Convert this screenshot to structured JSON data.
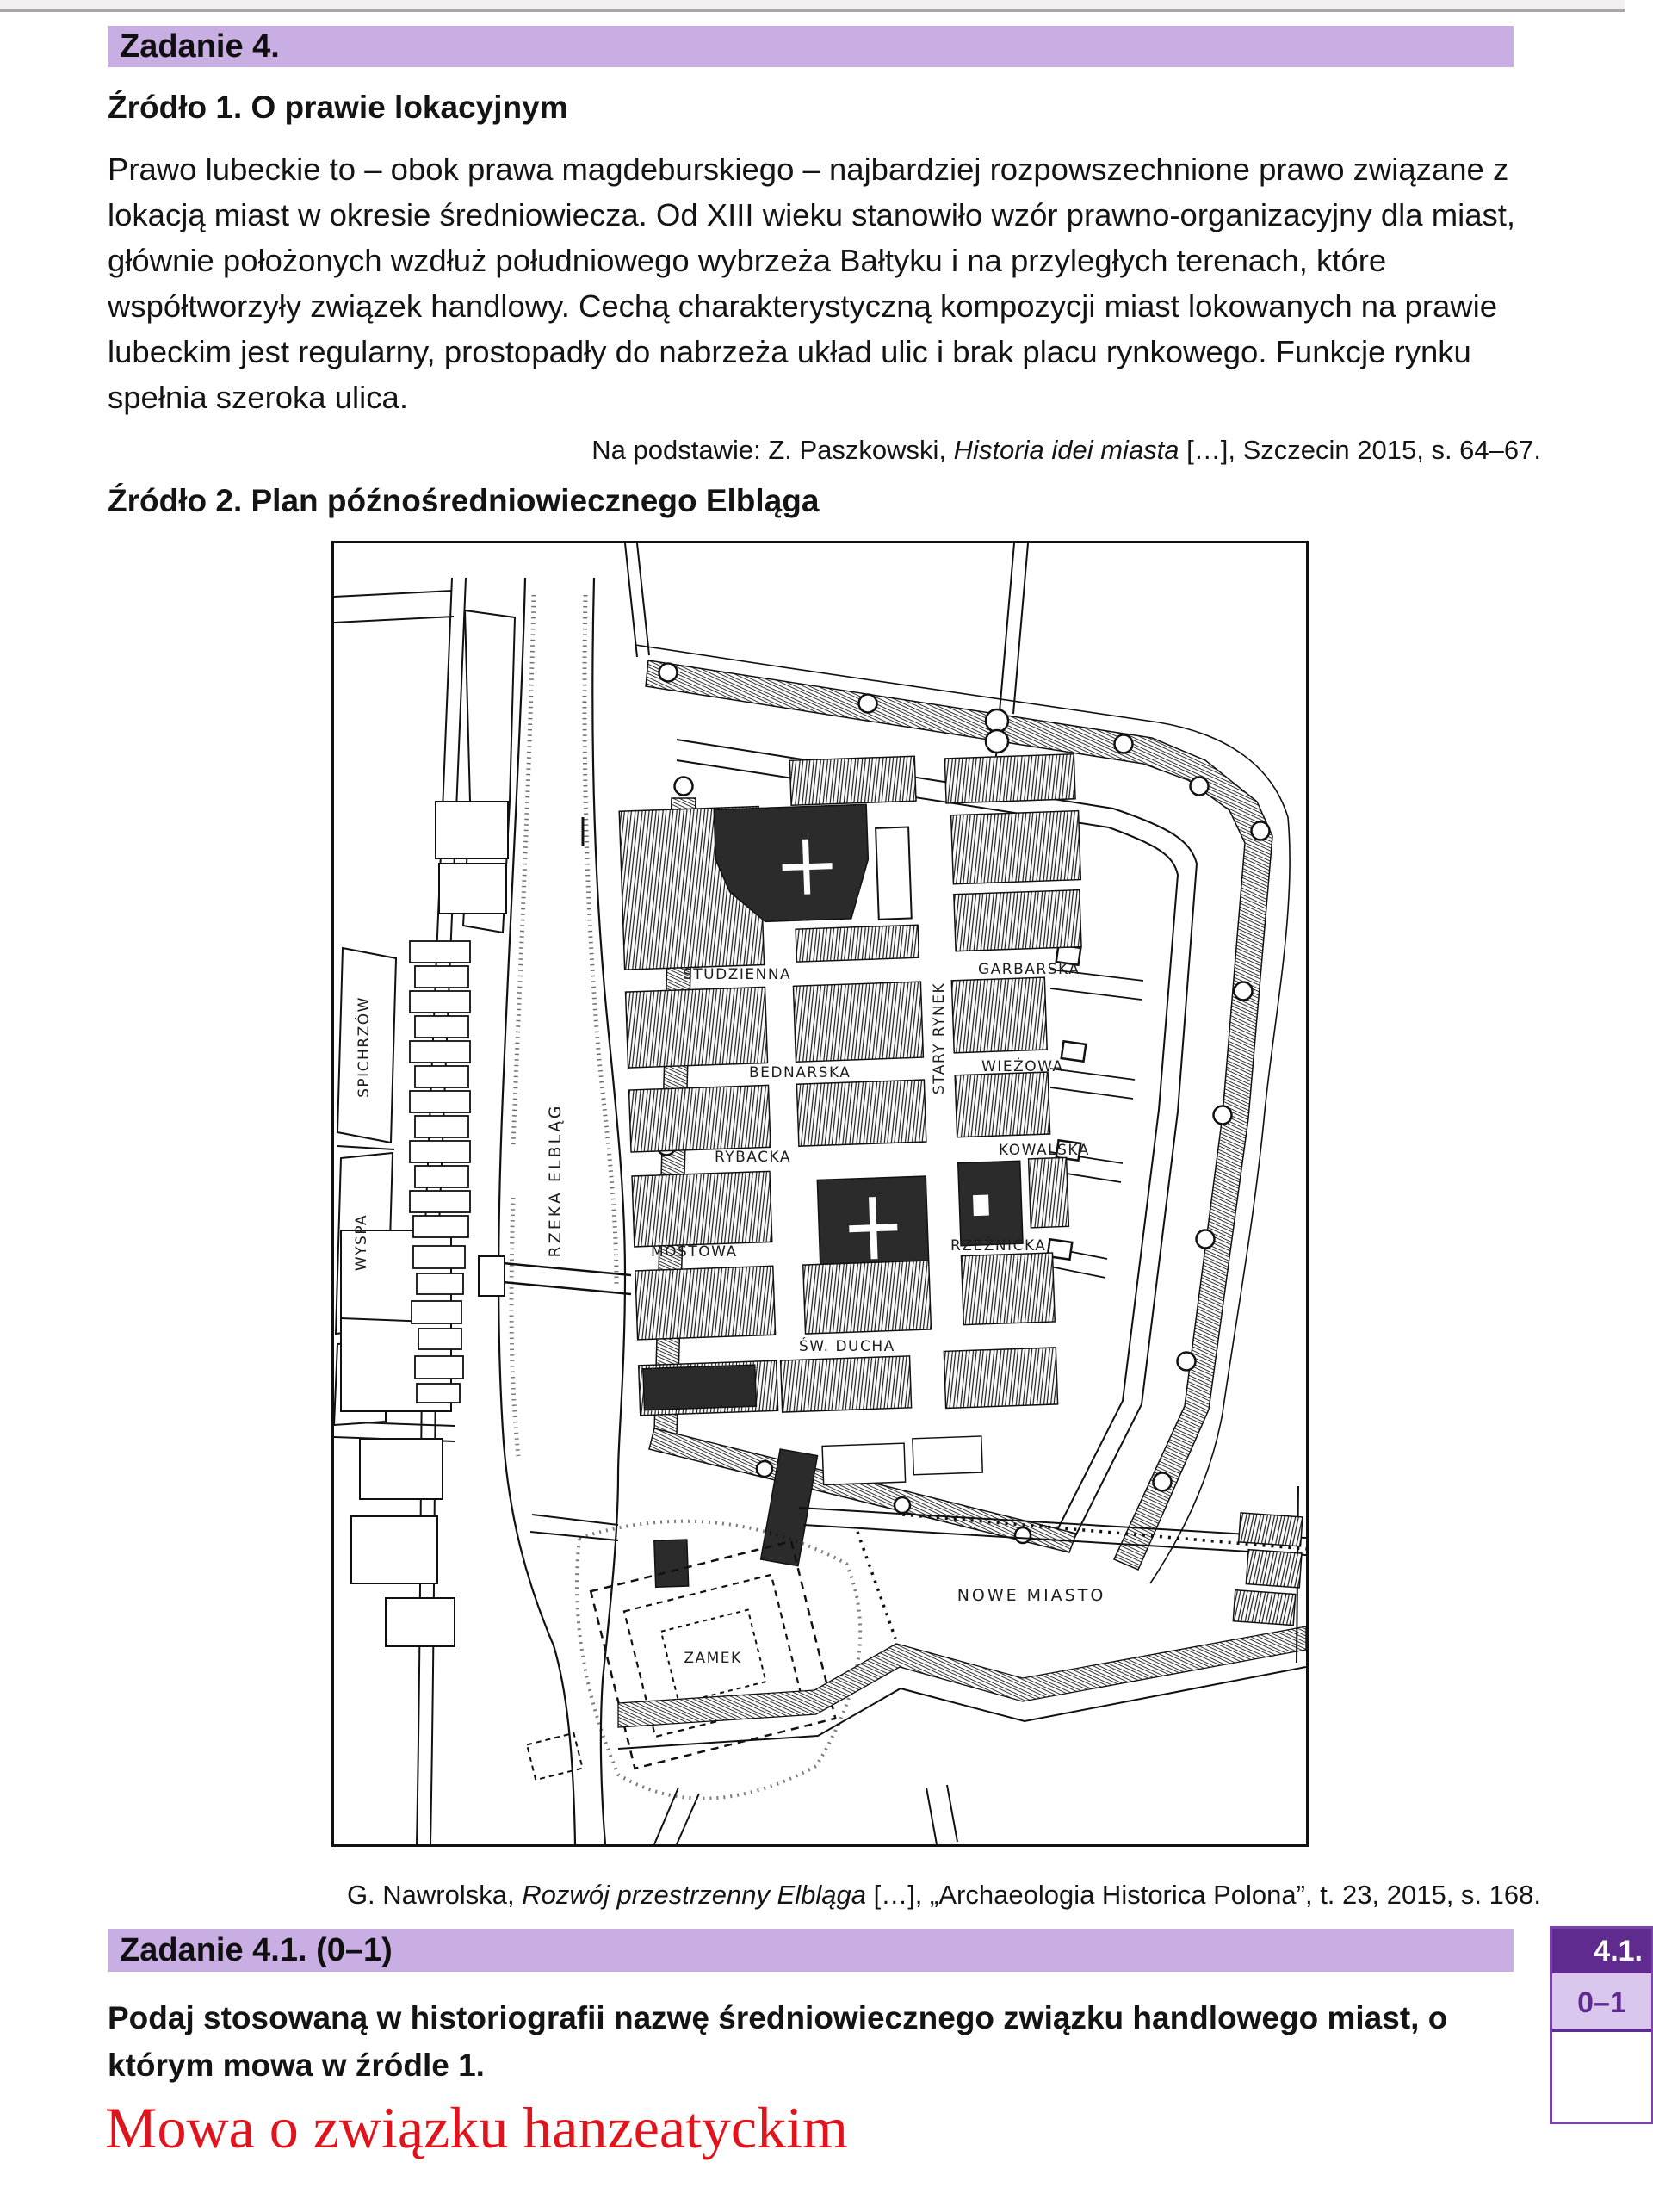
{
  "task4": {
    "title": "Zadanie 4."
  },
  "source1": {
    "heading": "Źródło 1. O prawie lokacyjnym",
    "body": "Prawo lubeckie to – obok prawa magdeburskiego – najbardziej rozpowszechnione prawo związane z lokacją miast w okresie średniowiecza. Od XIII wieku stanowiło wzór prawno-organizacyjny dla miast, głównie położonych wzdłuż południowego wybrzeża Bałtyku i na przyległych terenach, które współtworzyły związek handlowy. Cechą charakterystyczną kompozycji miast lokowanych na prawie lubeckim jest regularny, prostopadły do nabrzeża układ ulic i brak placu rynkowego. Funkcje rynku spełnia szeroka ulica.",
    "citation_prefix": "Na podstawie: Z. Paszkowski, ",
    "citation_title": "Historia idei miasta",
    "citation_suffix": " […], Szczecin 2015, s. 64–67."
  },
  "source2": {
    "heading": "Źródło 2. Plan późnośredniowiecznego Elbląga",
    "caption_prefix": "G. Nawrolska, ",
    "caption_title": "Rozwój przestrzenny Elbląga",
    "caption_suffix": " […], „Archaeologia Historica Polona”, t. 23, 2015, s. 168."
  },
  "map": {
    "labels": {
      "rzeka": "RZEKA ELBLĄG",
      "spichrzow": "SPICHRZÓW",
      "wyspa": "WYSPA",
      "studzienna": "STUDZIENNA",
      "garbarska": "GARBARSKA",
      "stary_rynek": "STARY RYNEK",
      "bednarska": "BEDNARSKA",
      "wiezowa": "WIEŻOWA",
      "rybacka": "RYBACKA",
      "kowalska": "KOWALSKA",
      "mostowa": "MOSTOWA",
      "rzeznicka": "RZEŹNICKA",
      "sw_ducha": "ŚW. DUCHA",
      "zamek": "ZAMEK",
      "nowe_miasto": "NOWE MIASTO"
    }
  },
  "task41": {
    "title": "Zadanie 4.1. (0–1)",
    "question": "Podaj stosowaną w historiografii nazwę średniowiecznego związku handlowego miast, o którym mowa w źródle 1.",
    "answer": "Mowa o związku hanzeatyckim",
    "badge": "4.1.",
    "points": "0–1"
  }
}
